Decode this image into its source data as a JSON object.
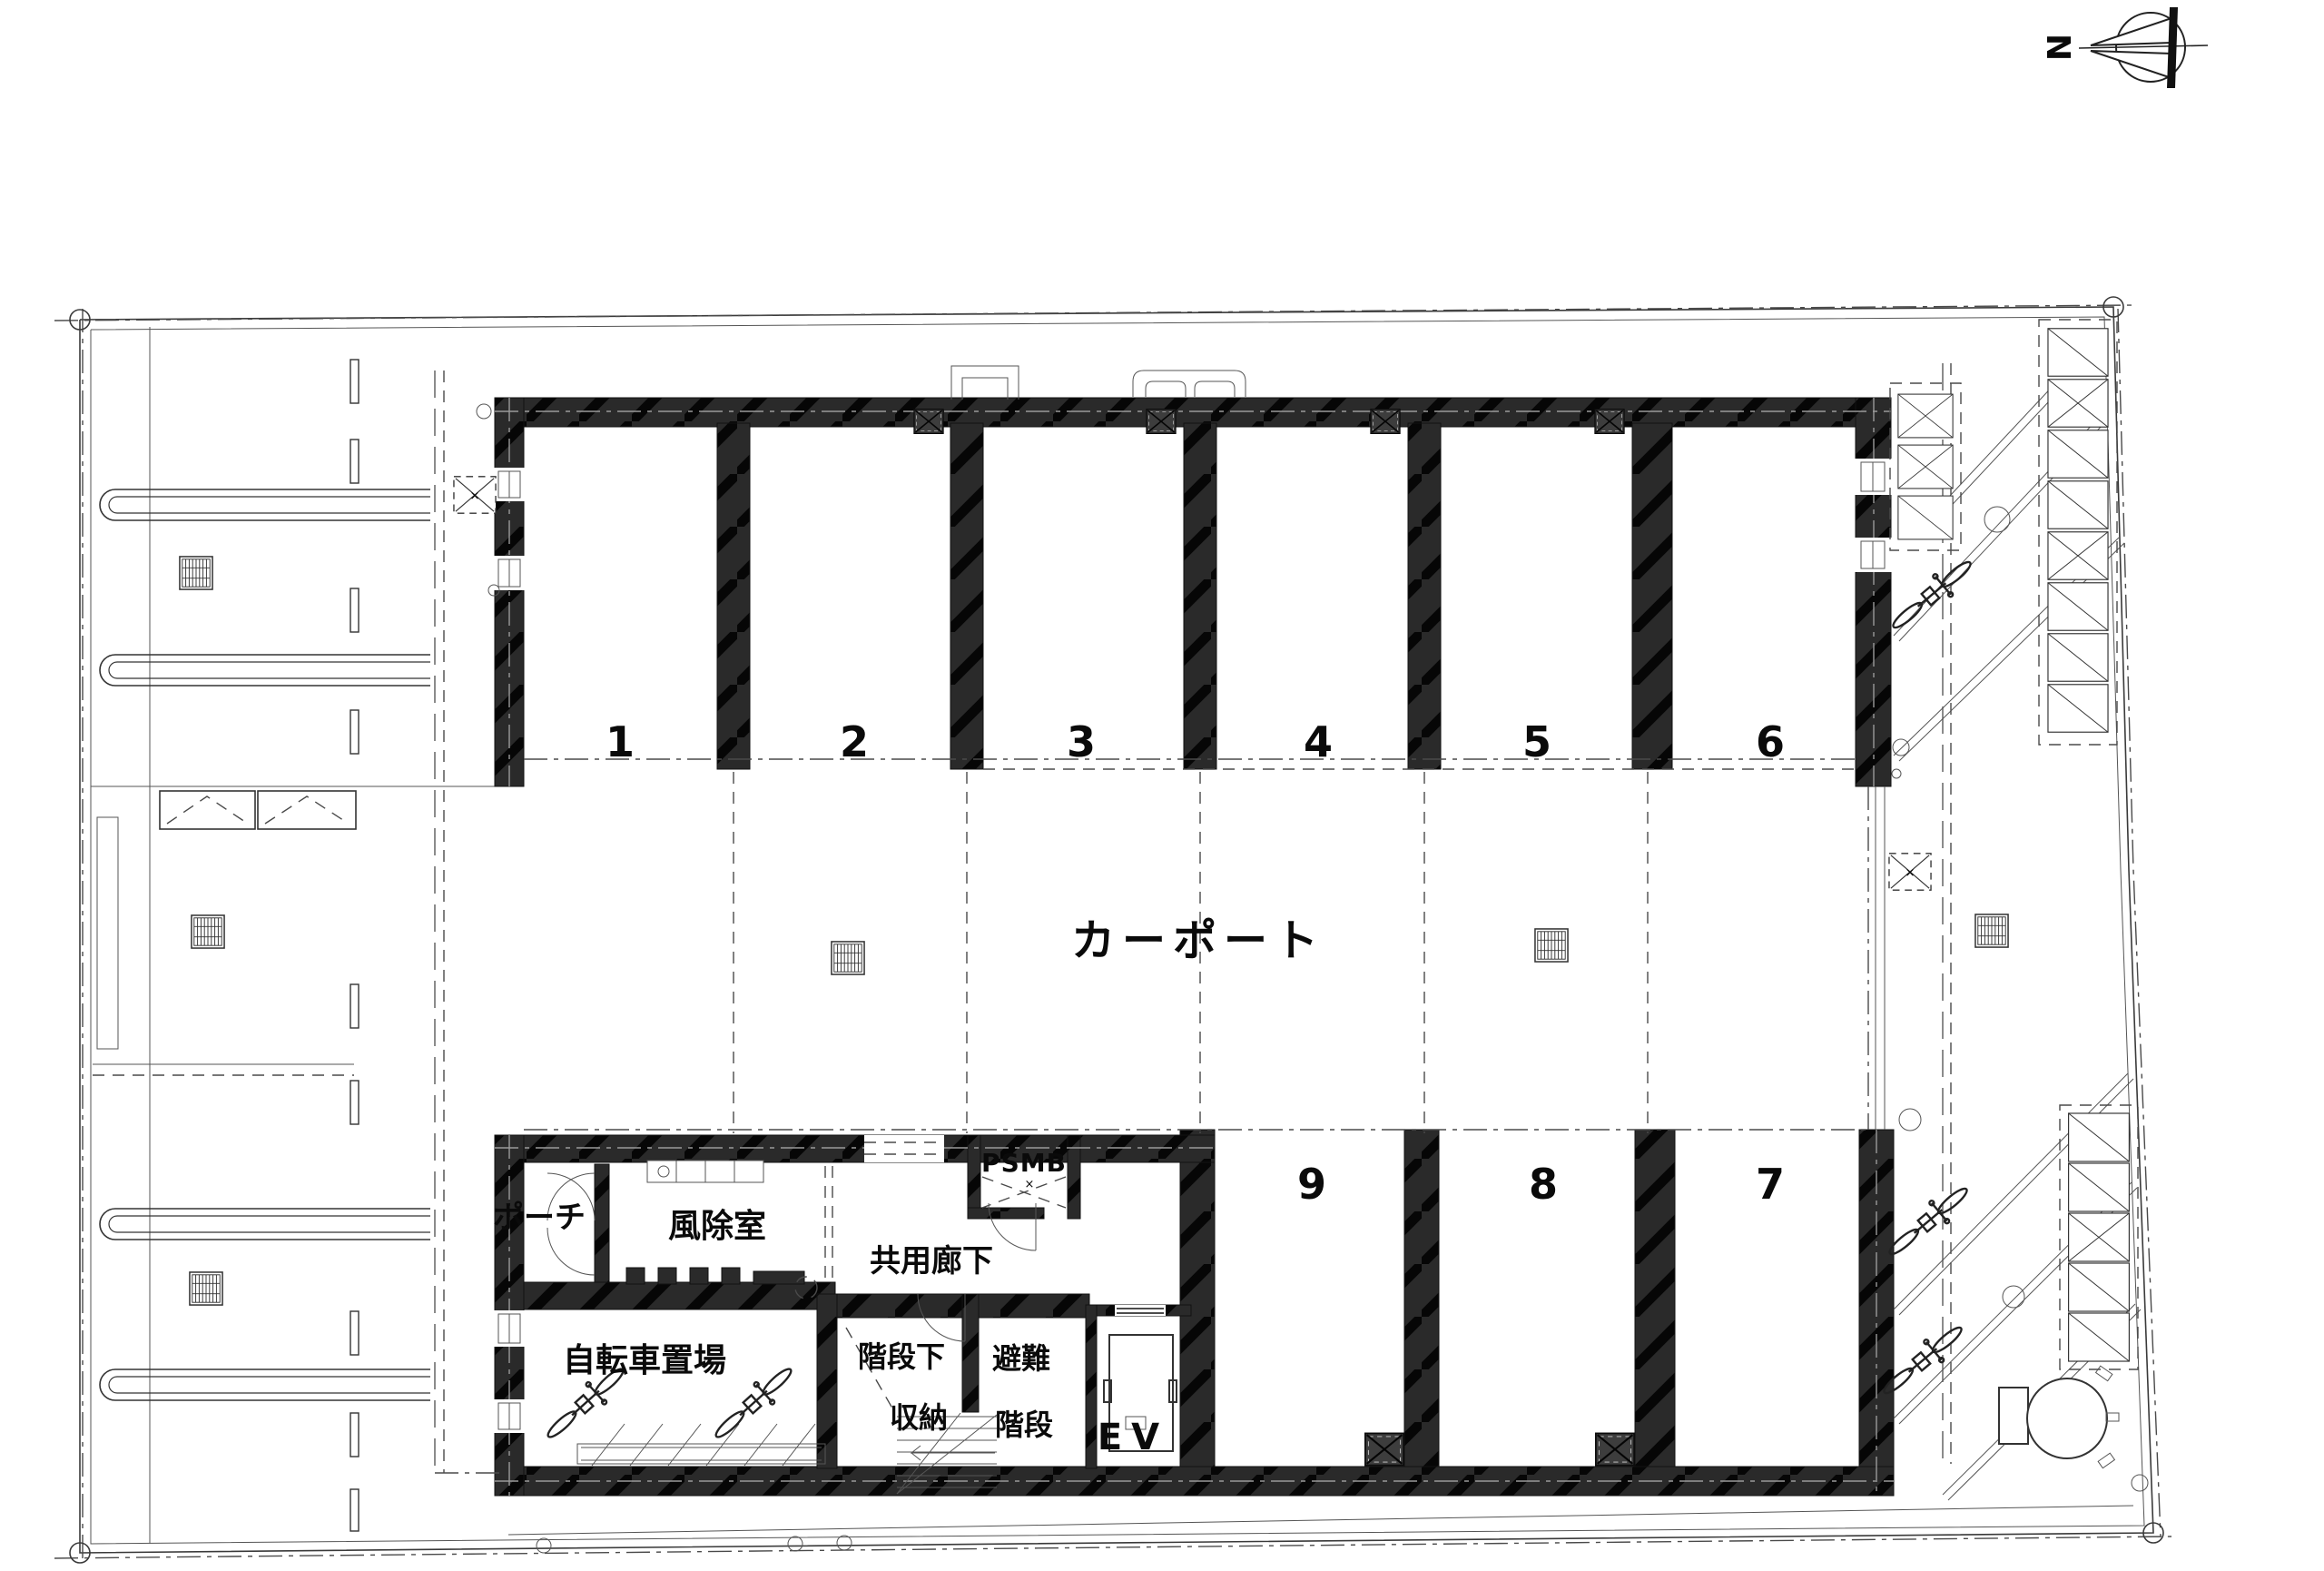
{
  "compass": {
    "north_label": "N"
  },
  "carport": {
    "label": "カーポート",
    "stall_numbers_top": [
      "1",
      "2",
      "3",
      "4",
      "5",
      "6"
    ],
    "stall_numbers_bottom": [
      "9",
      "8",
      "7"
    ]
  },
  "rooms": {
    "porch": "ポーチ",
    "windbreak_room": "風除室",
    "common_corridor": "共用廊下",
    "shaft": "PSMB",
    "bicycle_parking": "自転車置場",
    "under_stair_storage_line1": "階段下",
    "under_stair_storage_line2": "収納",
    "escape_stair_line1": "避難",
    "escape_stair_line2": "階段",
    "elevator": "EV"
  },
  "colors": {
    "wall": "#2a2a2a",
    "line": "#3a3a3a",
    "background": "#ffffff"
  }
}
